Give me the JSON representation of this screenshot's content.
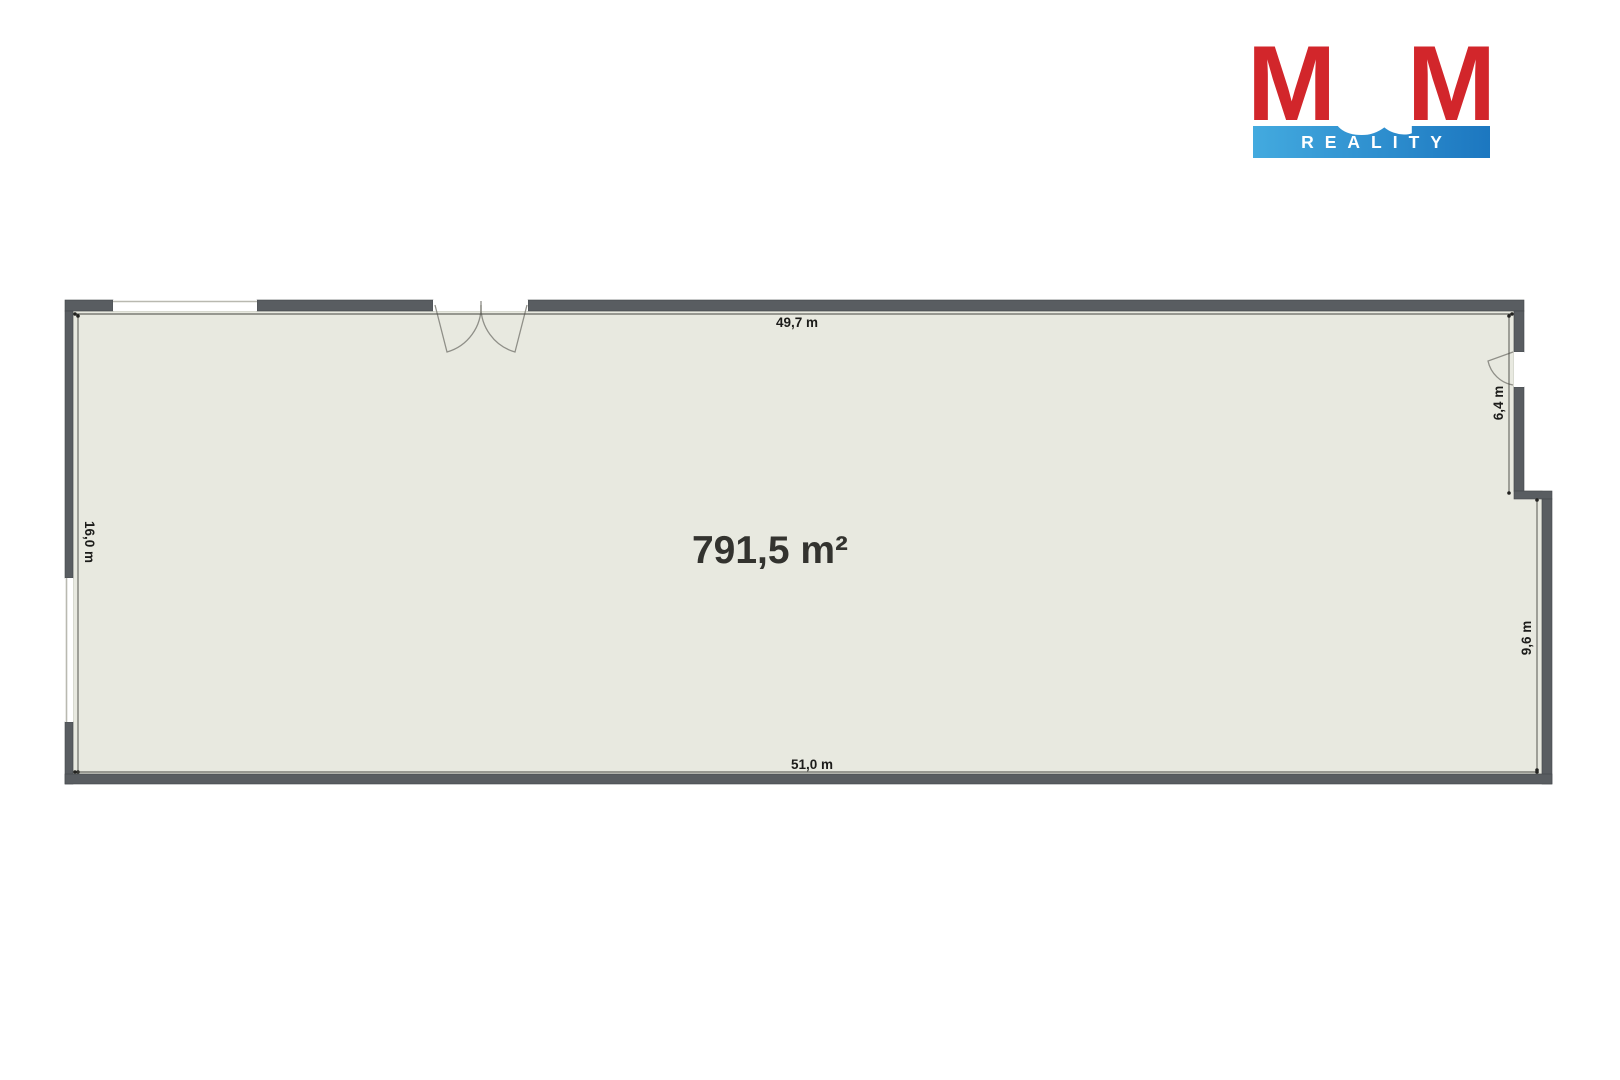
{
  "logo": {
    "m_left": "M",
    "ampersand": "&",
    "m_right": "M",
    "subtitle": "REALITY",
    "colors": {
      "red": "#d2262b",
      "blue_gradient_start": "#43aadf",
      "blue_gradient_end": "#1c77c0",
      "text_white": "#ffffff"
    }
  },
  "floorplan": {
    "area_label": "791,5 m²",
    "dim_top": "49,7 m",
    "dim_bottom": "51,0 m",
    "dim_left": "16,0 m",
    "dim_right_upper": "6,4 m",
    "dim_right_lower": "9,6 m",
    "colors": {
      "wall": "#595d61",
      "floor": "#e8e9e0",
      "floor_edge": "#c9cabf",
      "dimension_text": "#1c1c1a",
      "area_text": "#33332f",
      "door_stroke": "#8f8f88"
    }
  }
}
